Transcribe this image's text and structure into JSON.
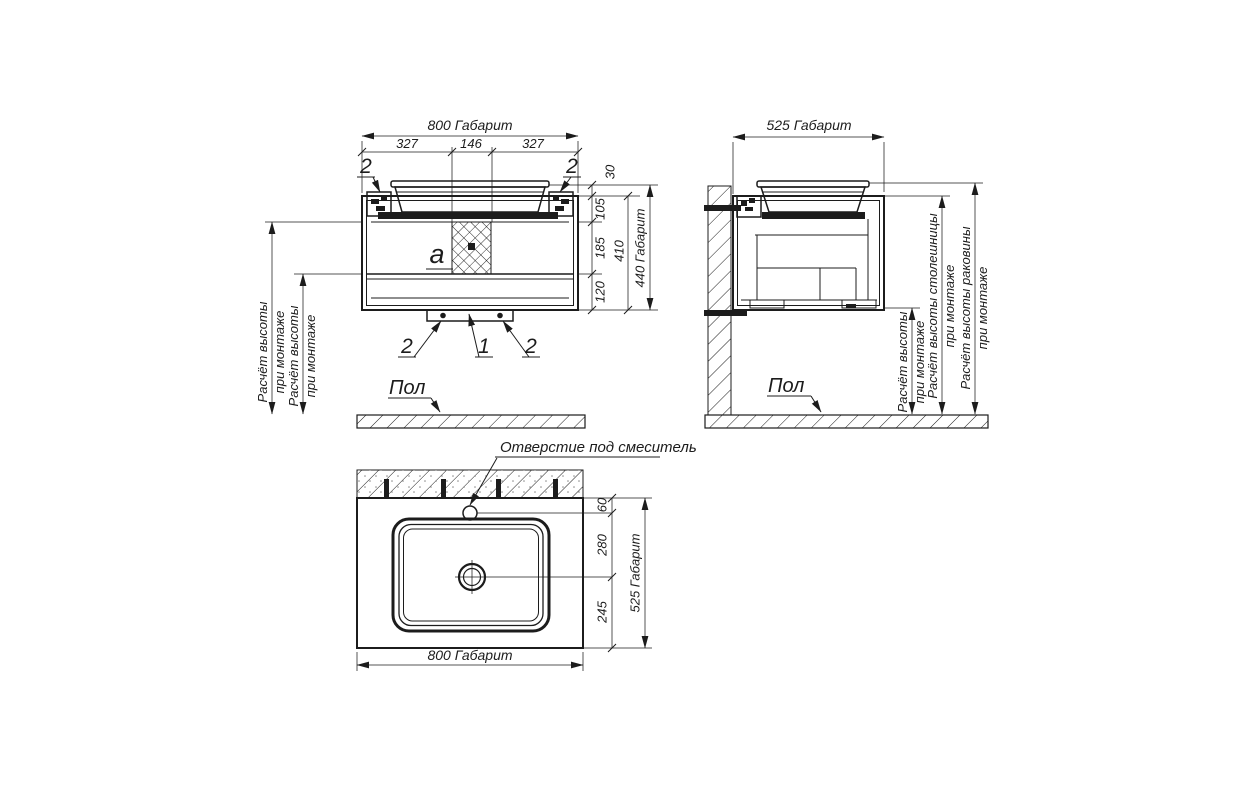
{
  "front_view": {
    "dim_overall_width": "800 Габарит",
    "dim_left_section": "327",
    "dim_center_section": "146",
    "dim_right_section": "327",
    "dim_sink_rim": "30",
    "dim_top_section": "105",
    "dim_middle_section": "185",
    "dim_bottom_section": "120",
    "dim_cabinet_height": "410",
    "dim_overall_height": "440 Габарит",
    "detail_label": "a",
    "callout_bracket_left": "2",
    "callout_bracket_right": "2",
    "callout_rail_screw_left": "2",
    "callout_rail": "1",
    "callout_rail_screw_right": "2",
    "floor_label": "Пол",
    "mount_height_note_line1": "Расчёт высоты",
    "mount_height_note_line2": "при монтаже"
  },
  "side_view": {
    "dim_overall_depth": "525 Габарит",
    "floor_label": "Пол",
    "mount_height_note_line1": "Расчёт высоты",
    "mount_height_note_line2": "при монтаже",
    "countertop_height_note_line1": "Расчёт высоты столешницы",
    "countertop_height_note_line2": "при монтаже",
    "sink_height_note_line1": "Расчёт высоты раковины",
    "sink_height_note_line2": "при монтаже"
  },
  "top_view": {
    "faucet_hole_callout": "Отверстие под смеситель",
    "dim_faucet_offset": "60",
    "dim_faucet_to_drain": "280",
    "dim_drain_to_front_edge": "245",
    "dim_overall_depth": "525 Габарит",
    "dim_overall_width": "800 Габарит"
  },
  "colors": {
    "line": "#1c1c1c",
    "background": "#ffffff"
  }
}
